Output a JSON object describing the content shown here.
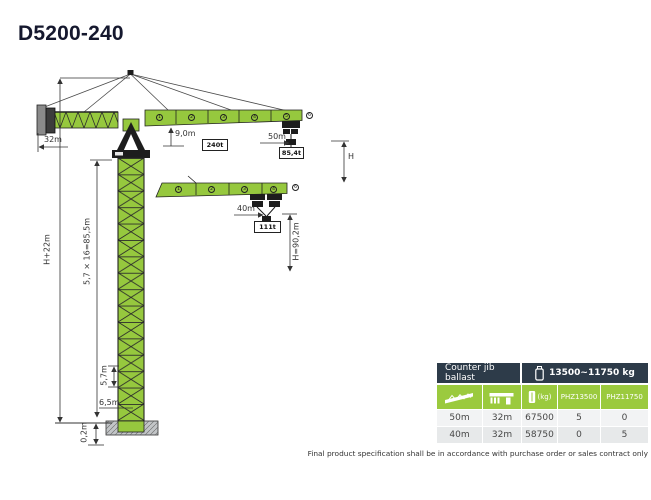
{
  "title": "D5200-240",
  "colors": {
    "crane_green": "#96c83e",
    "table_green": "#9bca3e",
    "table_dark": "#2d3b49"
  },
  "diagram": {
    "dims": {
      "counter_jib_length": "32m",
      "min_radius": "9,0m",
      "jib_50_length": "50m",
      "hook_height_symbol": "H",
      "jib_40_length": "40m",
      "jib_40_hook_height": "H=90,2m",
      "total_height": "H+22m",
      "mast_formula": "5,7 × 16=85,5m",
      "mast_section_height": "5,7m",
      "base_height": "6,5m",
      "foundation_height": "0,2m"
    },
    "loads": {
      "max_load": "240t",
      "jib_50_tip_load": "85,4t",
      "jib_40_tip_load": "111t"
    },
    "jib50_sections": [
      "1",
      "2",
      "3",
      "4",
      "5"
    ],
    "jib50_tip_section": "6",
    "jib40_sections": [
      "1",
      "2",
      "3",
      "4"
    ],
    "jib40_tip_section": "6"
  },
  "table": {
    "header_left": "Counter jib ballast",
    "header_right": "13500~11750 kg",
    "col_unit": "(kg)",
    "col_phz13500": "PHZ13500",
    "col_phz11750": "PHZ11750",
    "rows": [
      [
        "50m",
        "32m",
        "67500",
        "5",
        "0"
      ],
      [
        "40m",
        "32m",
        "58750",
        "0",
        "5"
      ]
    ]
  },
  "footer": "Final product specification shall be in accordance with purchase order or sales contract only"
}
